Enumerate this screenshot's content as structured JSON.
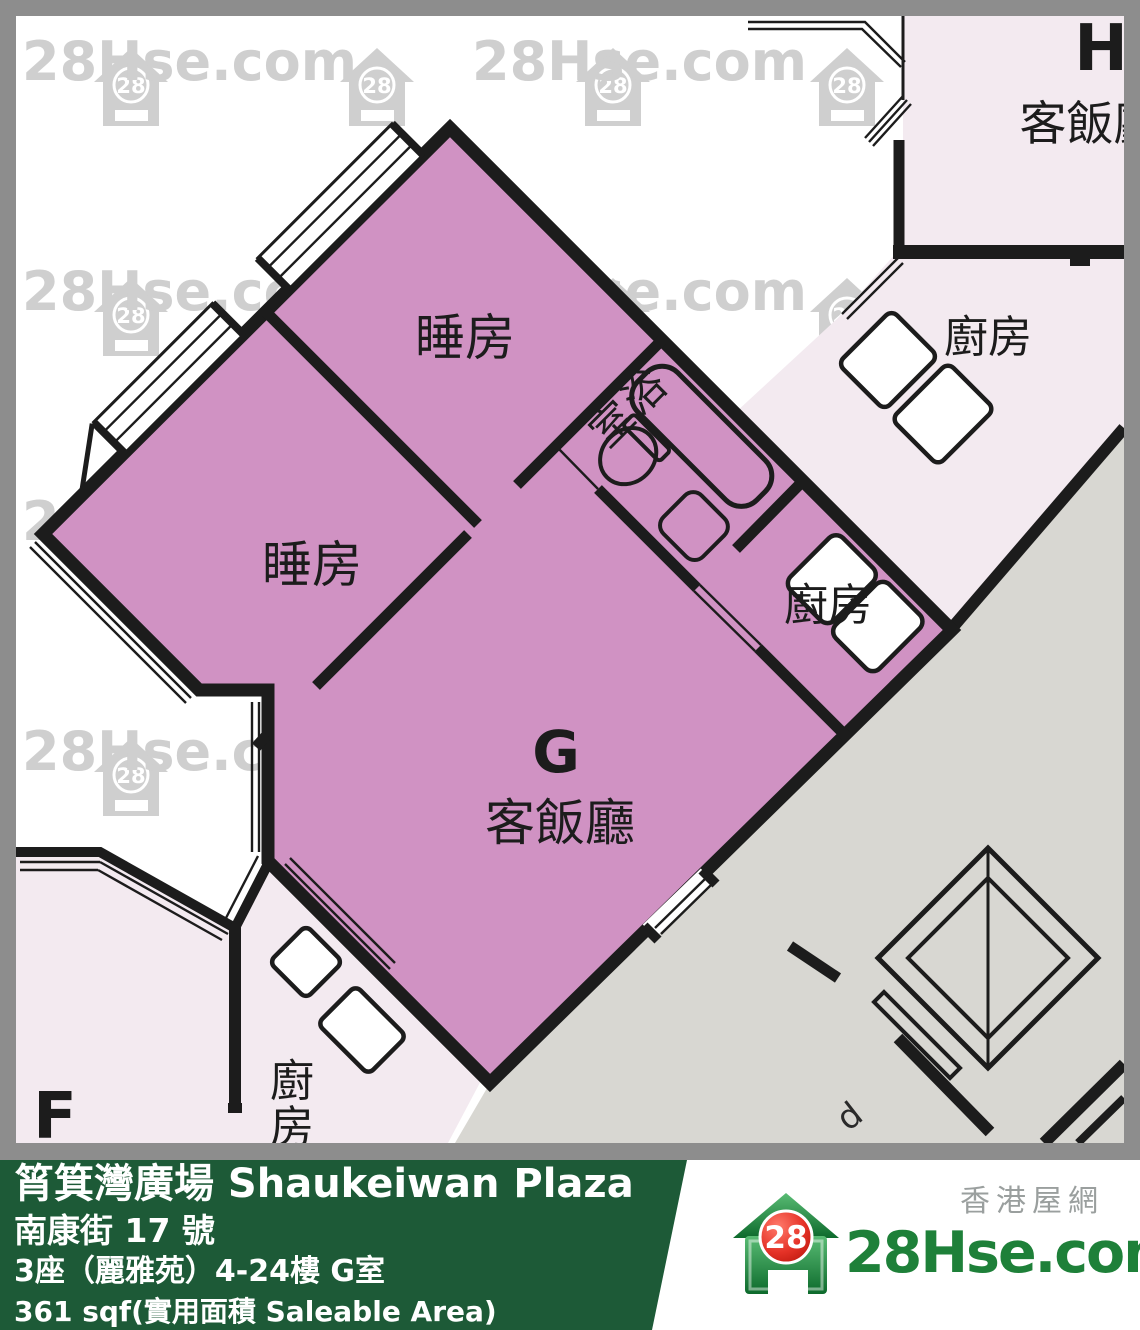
{
  "watermark": {
    "text": "28Hse.com",
    "badge": "28"
  },
  "plan": {
    "unit_g": {
      "letter": "G",
      "living_label": "客飯廳",
      "bedroom_label": "睡房",
      "bathroom_label": "浴室",
      "kitchen_label": "廚房"
    },
    "unit_h": {
      "letter": "H",
      "living_label": "客飯廳",
      "kitchen_label": "廚房"
    },
    "unit_f": {
      "letter": "F",
      "kitchen_label": "廚房"
    },
    "corridor_label": "d"
  },
  "footer": {
    "title": "筲箕灣廣場 Shaukeiwan Plaza",
    "address": "南康街 17 號",
    "block": "3座（麗雅苑）4-24樓 G室",
    "area": "361 sqf(實用面積 Saleable Area)"
  },
  "logo": {
    "badge": "28",
    "site": "28Hse.com",
    "tagline": "香港屋網"
  },
  "colors": {
    "pink": "#d092c3",
    "pale": "#f3eaf0",
    "corridor": "#d8d7d2",
    "wall": "#1c1c1c",
    "frame": "#8d8d8d",
    "watermark": "#9e9e9e",
    "green": "#1d5a37",
    "logo_green": "#1e8039",
    "badge_red": "#d9261c"
  }
}
